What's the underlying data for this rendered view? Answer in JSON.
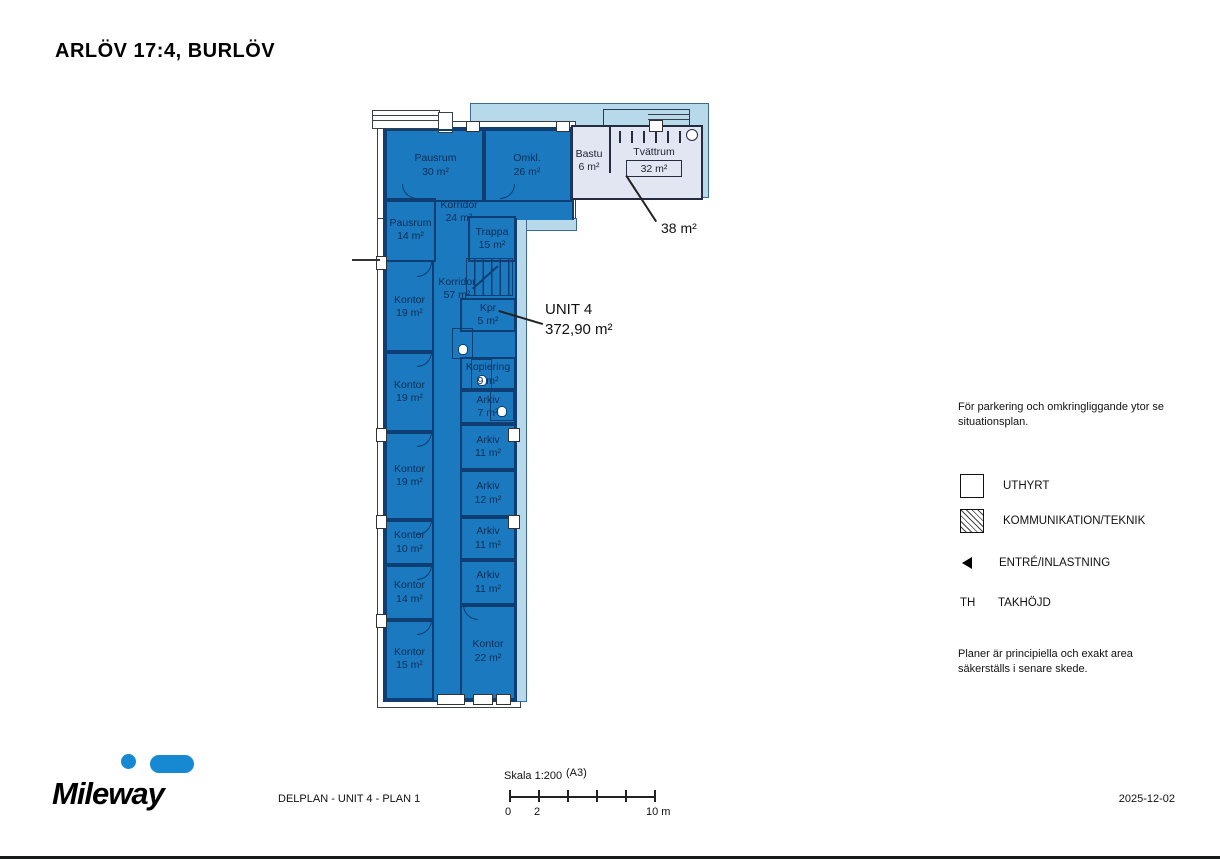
{
  "title": "ARLÖV 17:4, BURLÖV",
  "plan": {
    "unit": {
      "name": "UNIT 4",
      "area": "372,90 m²"
    },
    "annex_area": "38 m²",
    "rooms": [
      {
        "name": "Pausrum",
        "area": "30 m²"
      },
      {
        "name": "Omkl.",
        "area": "26 m²"
      },
      {
        "name": "Bastu",
        "area": "6 m²"
      },
      {
        "name": "Tvättrum",
        "area": "32 m²"
      },
      {
        "name": "Pausrum",
        "area": "14 m²"
      },
      {
        "name": "Korridor",
        "area": "24 m²"
      },
      {
        "name": "Trappa",
        "area": "15 m²"
      },
      {
        "name": "Korridor",
        "area": "57 m²"
      },
      {
        "name": "Kontor",
        "area": "19 m²"
      },
      {
        "name": "Kpr",
        "area": "5 m²"
      },
      {
        "name": "Kopiering",
        "area": "9 m²"
      },
      {
        "name": "Arkiv",
        "area": "7 m²"
      },
      {
        "name": "Arkiv",
        "area": "11 m²"
      },
      {
        "name": "Kontor",
        "area": "19 m²"
      },
      {
        "name": "Kontor",
        "area": "19 m²"
      },
      {
        "name": "Arkiv",
        "area": "12 m²"
      },
      {
        "name": "Arkiv",
        "area": "11 m²"
      },
      {
        "name": "Kontor",
        "area": "10 m²"
      },
      {
        "name": "Arkiv",
        "area": "11 m²"
      },
      {
        "name": "Kontor",
        "area": "14 m²"
      },
      {
        "name": "Kontor",
        "area": "22 m²"
      },
      {
        "name": "Kontor",
        "area": "15 m²"
      }
    ]
  },
  "legend": {
    "note_top": "För parkering och omkringliggande ytor se situationsplan.",
    "items": [
      {
        "label": "UTHYRT"
      },
      {
        "label": "KOMMUNIKATION/TEKNIK"
      },
      {
        "label": "ENTRÉ/INLASTNING"
      },
      {
        "symbol": "TH",
        "label": "TAKHÖJD"
      }
    ],
    "note_bottom": "Planer är principiella och exakt area säkerställs i senare skede."
  },
  "scalebar": {
    "label": "Skala 1:200",
    "paper": "(A3)",
    "tick_start": "0",
    "tick_2": "2",
    "tick_end": "10 m"
  },
  "footer": {
    "logo": "Mileway",
    "drawing_title": "DELPLAN - UNIT 4 - PLAN 1",
    "date": "2025-12-02"
  },
  "colors": {
    "unit_fill": "#1b7abf",
    "adjacent_fill": "#b7d9ea",
    "technik_fill": "#e2e5f2",
    "wall": "#0f3e73",
    "logo_blue": "#1789d3"
  }
}
